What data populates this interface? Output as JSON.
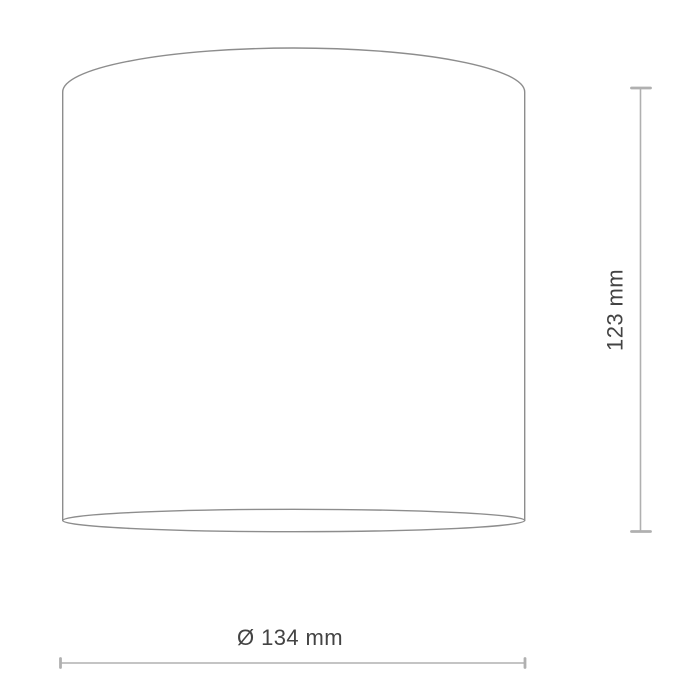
{
  "drawing": {
    "height_label": "123 mm",
    "diameter_label": "Ø 134 mm",
    "colors": {
      "background": "#ffffff",
      "outline_stroke": "#8d8d8d",
      "dimension_stroke": "#b0b0b0",
      "label_text": "#434343"
    }
  }
}
